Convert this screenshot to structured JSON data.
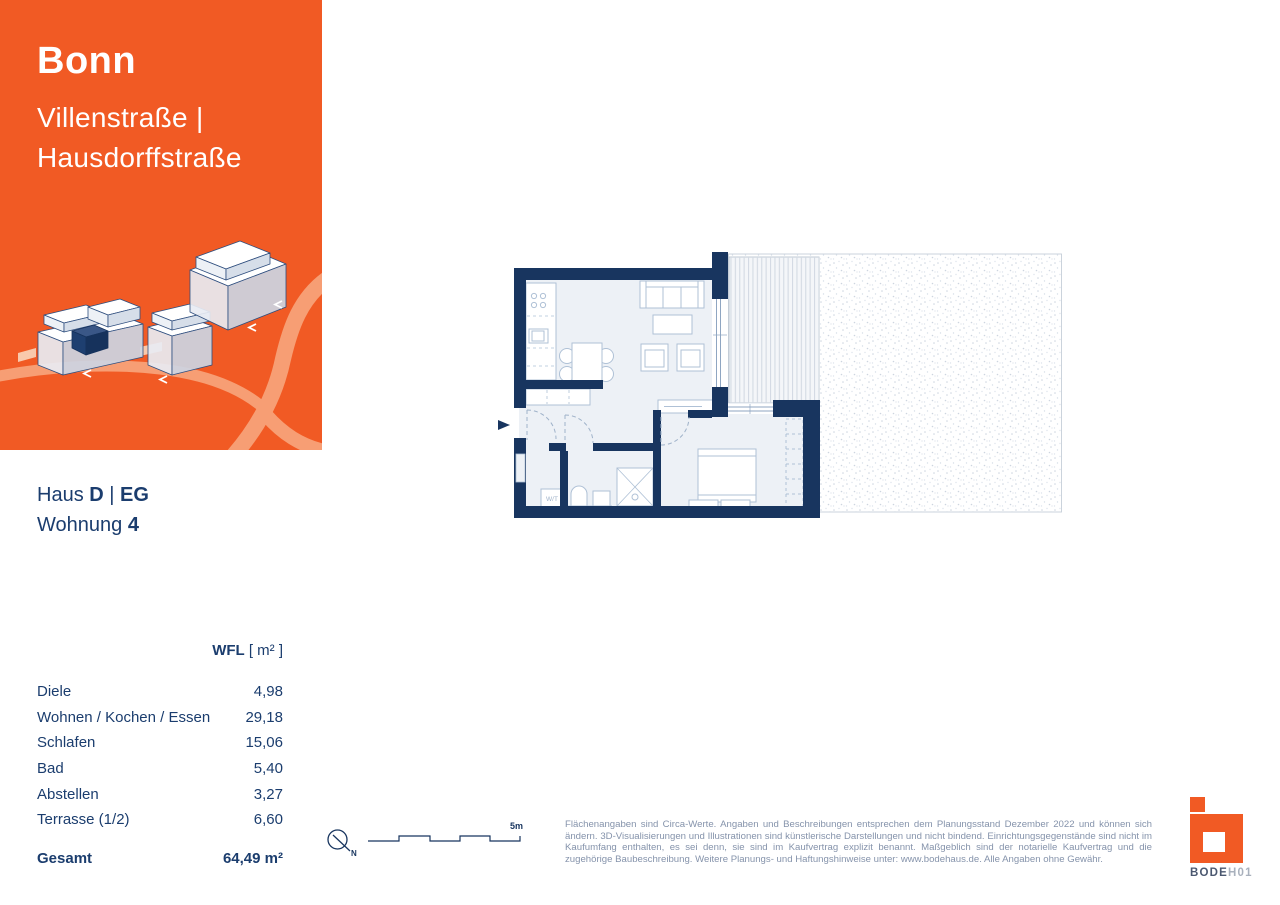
{
  "header": {
    "city": "Bonn",
    "street_line1": "Villenstraße |",
    "street_line2": "Hausdorffstraße"
  },
  "unit": {
    "haus_label": "Haus",
    "haus_value": "D",
    "separator": "|",
    "floor": "EG",
    "wohnung_label": "Wohnung",
    "wohnung_number": "4"
  },
  "area_table": {
    "header_bold": "WFL",
    "header_unit": " [ m² ]",
    "rows": [
      {
        "label": "Diele",
        "value": "4,98"
      },
      {
        "label": "Wohnen / Kochen / Essen",
        "value": "29,18"
      },
      {
        "label": "Schlafen",
        "value": "15,06"
      },
      {
        "label": "Bad",
        "value": "5,40"
      },
      {
        "label": "Abstellen",
        "value": "3,27"
      },
      {
        "label": "Terrasse (1/2)",
        "value": "6,60"
      }
    ],
    "total": {
      "label": "Gesamt",
      "value": "64,49 m²"
    }
  },
  "floorplan": {
    "wt_label": "W/T",
    "scale_label": "5m",
    "north_label": "N"
  },
  "disclaimer": {
    "text": "Flächenangaben sind Circa-Werte. Angaben und Beschreibungen entsprechen dem Planungsstand Dezember 2022 und können sich ändern. 3D-Visualisierungen und Illustrationen sind künstlerische Darstellungen und nicht bindend. Einrichtungsgegenstände sind nicht im Kaufumfang enthalten, es sei denn, sie sind im Kaufvertrag explizit benannt. Maßgeblich sind der notarielle Kaufvertrag und die zugehörige Baubeschreibung. Weitere Planungs- und Haftungshinweise unter: www.bodehaus.de. Alle Angaben ohne Gewähr."
  },
  "logo": {
    "word_bold": "BODE",
    "word_light": "H01"
  },
  "colors": {
    "accent_orange": "#F15A24",
    "road_orange": "#F79E74",
    "wall_navy": "#18355F",
    "text_navy": "#1B3D6E",
    "floor_fill": "#EDF1F6"
  }
}
